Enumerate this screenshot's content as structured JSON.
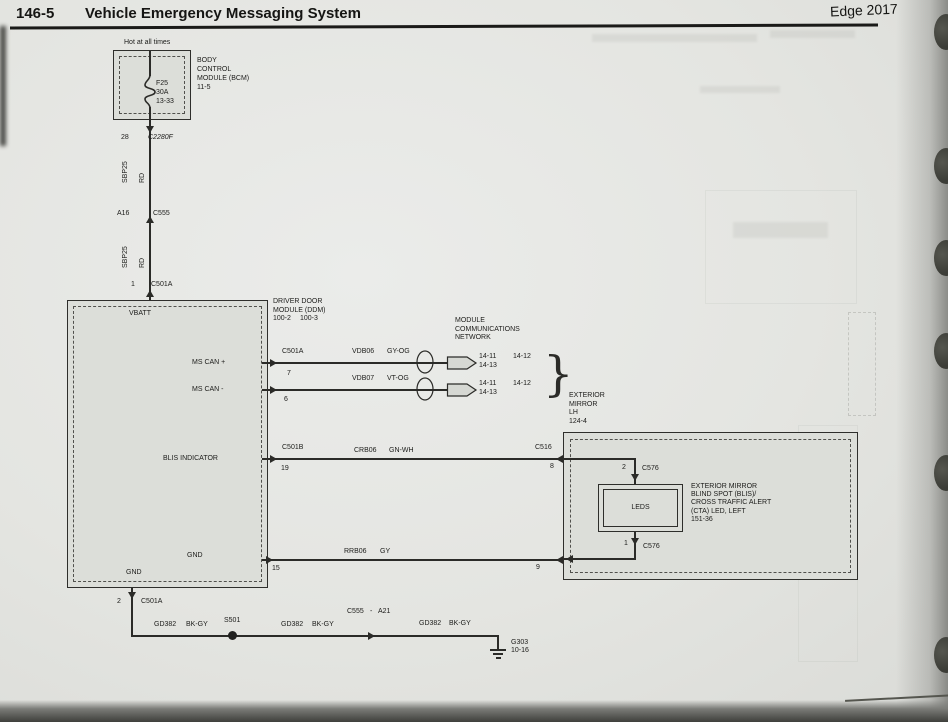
{
  "header": {
    "page_number": "146-5",
    "title": "Vehicle Emergency Messaging System",
    "edition": "Edge 2017"
  },
  "colors": {
    "paper": "#e4e5e1",
    "ink": "#2b2b28",
    "box_fill": "#dcded9"
  },
  "bcm": {
    "hot_label": "Hot at all times",
    "fuse_name": "F25",
    "fuse_rating": "30A",
    "fuse_ref": "13-33",
    "label_lines": [
      "BODY",
      "CONTROL",
      "MODULE (BCM)",
      "11-5"
    ]
  },
  "feed": {
    "c2280f": {
      "pin": "28",
      "name": "C2280F"
    },
    "seg1": {
      "circuit": "SBP25",
      "color": "RD"
    },
    "c555": {
      "pin": "A16",
      "name": "C555"
    },
    "seg2": {
      "circuit": "SBP25",
      "color": "RD"
    },
    "c501a": {
      "pin": "1",
      "name": "C501A"
    }
  },
  "ddm": {
    "label_lines": [
      "DRIVER DOOR",
      "MODULE (DDM)"
    ],
    "ref_a": "100-2",
    "ref_b": "100-3",
    "vbatt": "VBATT",
    "ms_can_p": "MS CAN +",
    "ms_can_m": "MS CAN -",
    "blis": "BLIS INDICATOR",
    "gnd": "GND",
    "gnd2": "GND"
  },
  "network": {
    "header_lines": [
      "MODULE",
      "COMMUNICATIONS",
      "NETWORK"
    ],
    "brace": "}",
    "row1": {
      "connector": "C501A",
      "pin": "7",
      "circuit": "VDB06",
      "color": "GY-OG",
      "ref1": "14-11",
      "ref2": "14-13",
      "ref3": "14-12"
    },
    "row2": {
      "pin": "6",
      "circuit": "VDB07",
      "color": "VT-OG",
      "ref1": "14-11",
      "ref2": "14-13",
      "ref3": "14-12"
    }
  },
  "blis_wire": {
    "connector": "C501B",
    "pin": "19",
    "circuit": "CRB06",
    "color": "GN-WH",
    "to_connector": "C516",
    "to_pin": "8"
  },
  "gnd_wire": {
    "pin": "15",
    "circuit": "RRB06",
    "color": "GY",
    "to_pin": "9"
  },
  "mirror": {
    "label_lines": [
      "EXTERIOR",
      "MIRROR",
      "LH",
      "124-4"
    ],
    "top_pin": "2",
    "top_conn": "C576",
    "leds": "LEDS",
    "bottom_pin": "1",
    "bottom_conn": "C576",
    "led_label_lines": [
      "EXTERIOR MIRROR",
      "BLIND SPOT (BLIS)/",
      "CROSS TRAFFIC ALERT",
      "(CTA) LED, LEFT",
      "151-36"
    ]
  },
  "ground": {
    "exit": {
      "pin": "2",
      "name": "C501A"
    },
    "seg1": {
      "circuit": "GD382",
      "color": "BK-GY"
    },
    "splice": "S501",
    "seg2": {
      "circuit": "GD382",
      "color": "BK-GY"
    },
    "conn": {
      "name": "C555",
      "sep": "-",
      "pin": "A21"
    },
    "seg3": {
      "circuit": "GD382",
      "color": "BK-GY"
    },
    "gnd": {
      "name": "G303",
      "ref": "10-16"
    }
  }
}
